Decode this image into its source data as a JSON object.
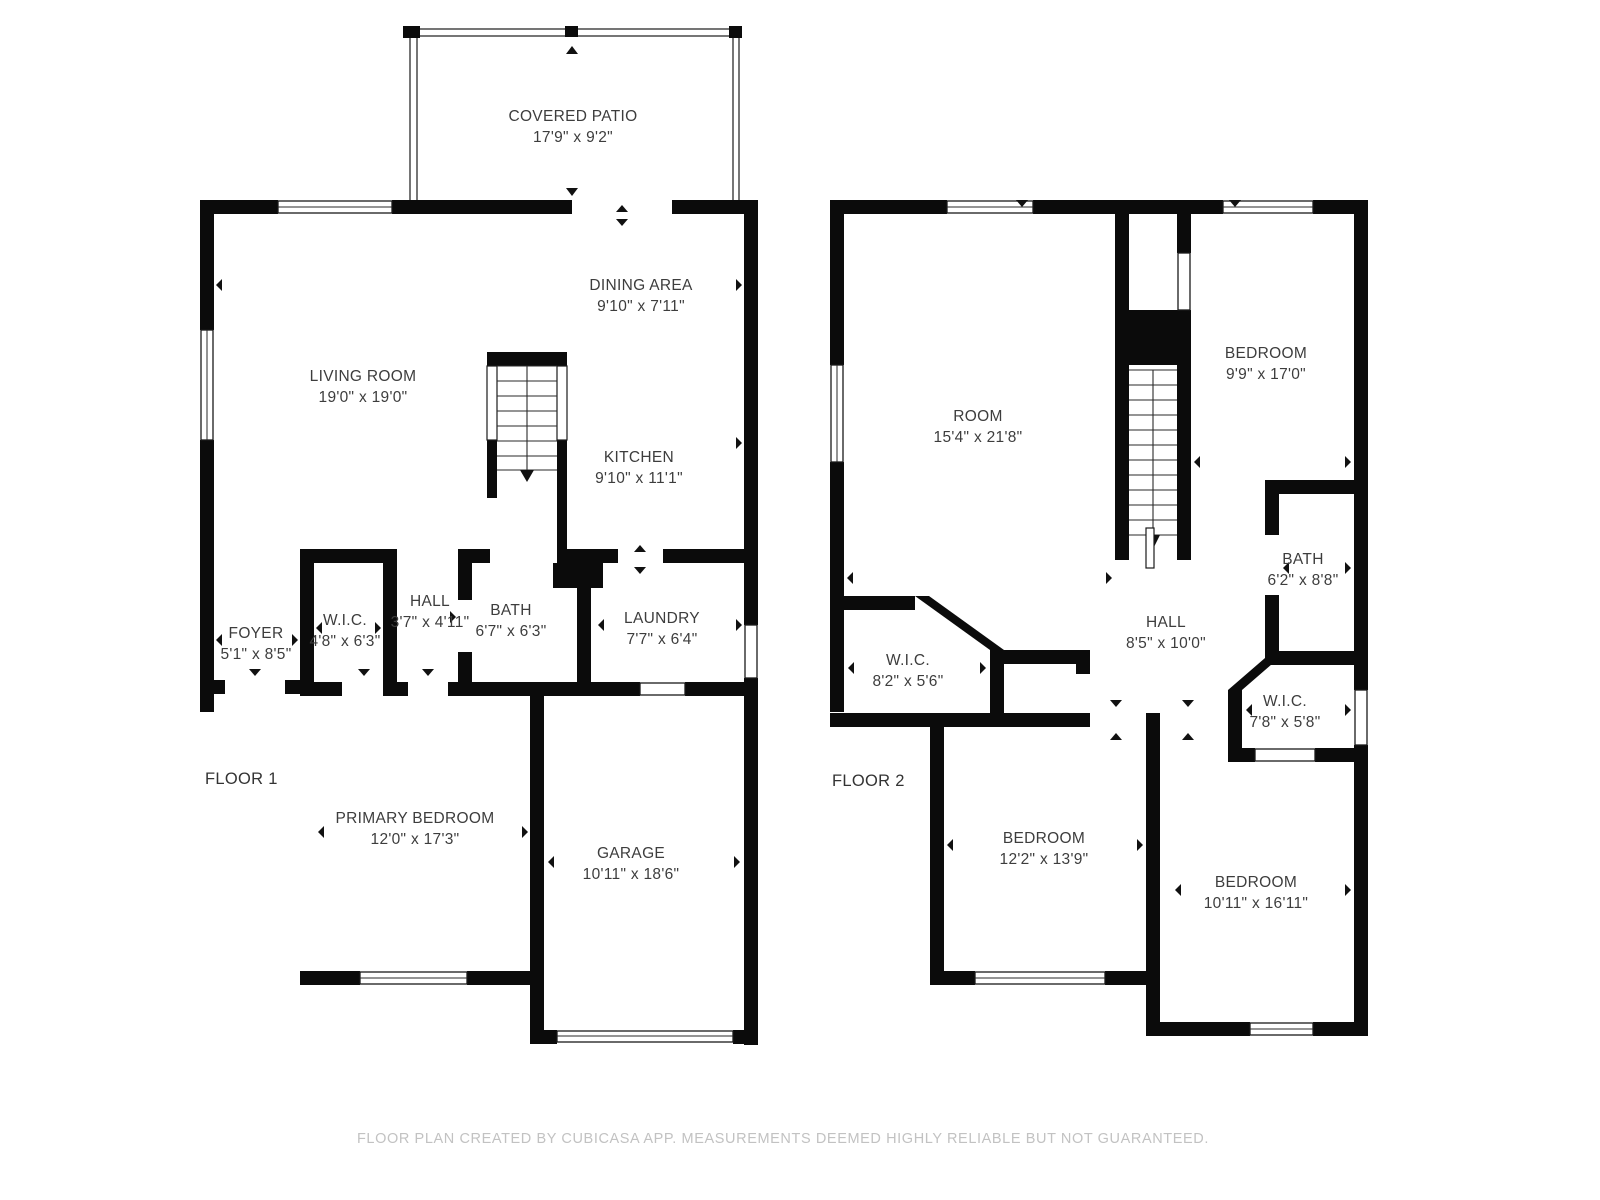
{
  "footer": {
    "text": "FLOOR PLAN CREATED BY CUBICASA APP. MEASUREMENTS DEEMED HIGHLY RELIABLE BUT NOT GUARANTEED."
  },
  "colors": {
    "wall": "#0b0b0b",
    "label": "#3d3d3d",
    "footer": "#c2c2c2",
    "background": "#ffffff"
  },
  "floor1": {
    "label": "FLOOR 1",
    "rooms": [
      {
        "name": "COVERED PATIO",
        "dims": "17'9\" x 9'2\""
      },
      {
        "name": "LIVING ROOM",
        "dims": "19'0\" x 19'0\""
      },
      {
        "name": "DINING AREA",
        "dims": "9'10\" x 7'11\""
      },
      {
        "name": "KITCHEN",
        "dims": "9'10\" x 11'1\""
      },
      {
        "name": "FOYER",
        "dims": "5'1\" x 8'5\""
      },
      {
        "name": "W.I.C.",
        "dims": "4'8\" x 6'3\""
      },
      {
        "name": "HALL",
        "dims": "3'7\" x 4'11\""
      },
      {
        "name": "BATH",
        "dims": "6'7\" x 6'3\""
      },
      {
        "name": "LAUNDRY",
        "dims": "7'7\" x 6'4\""
      },
      {
        "name": "PRIMARY BEDROOM",
        "dims": "12'0\" x 17'3\""
      },
      {
        "name": "GARAGE",
        "dims": "10'11\" x 18'6\""
      }
    ]
  },
  "floor2": {
    "label": "FLOOR 2",
    "rooms": [
      {
        "name": "ROOM",
        "dims": "15'4\" x 21'8\""
      },
      {
        "name": "BEDROOM",
        "dims": "9'9\" x 17'0\""
      },
      {
        "name": "BATH",
        "dims": "6'2\" x 8'8\""
      },
      {
        "name": "HALL",
        "dims": "8'5\" x 10'0\""
      },
      {
        "name": "W.I.C.",
        "dims": "8'2\" x 5'6\""
      },
      {
        "name": "W.I.C.",
        "dims": "7'8\" x 5'8\""
      },
      {
        "name": "BEDROOM",
        "dims": "12'2\" x 13'9\""
      },
      {
        "name": "BEDROOM",
        "dims": "10'11\" x 16'11\""
      }
    ]
  }
}
